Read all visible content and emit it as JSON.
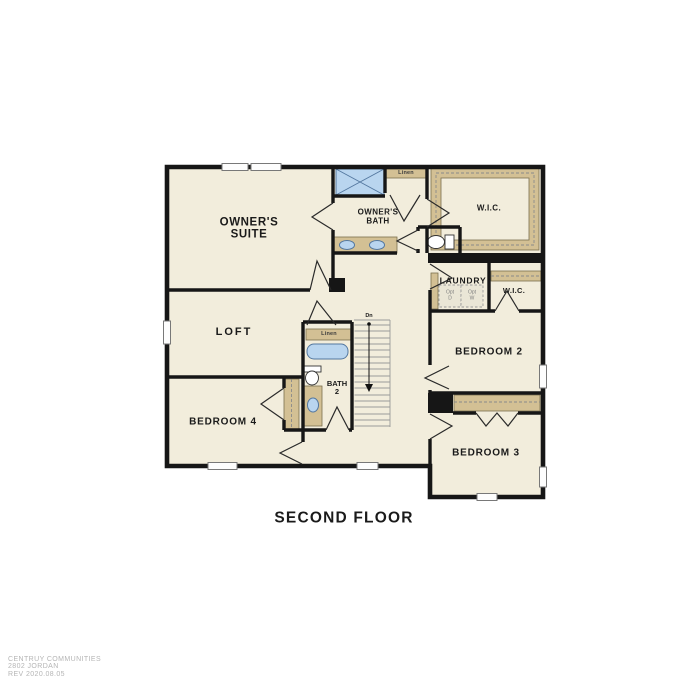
{
  "title": "SECOND FLOOR",
  "footer": {
    "line1": "CENTRUY COMMUNITIES",
    "line2": "2802 JORDAN",
    "line3": "REV 2020.08.05"
  },
  "colors": {
    "room_fill": "#f2eddc",
    "wall": "#161616",
    "cabinet_tan": "#d3c094",
    "fixture_blue": "#b9d5ef",
    "fixture_blue_border": "#53779f",
    "stair_gray": "#9a9a9a",
    "footer_gray": "#b5b5b5"
  },
  "plan": {
    "rooms": {
      "owners_suite": {
        "line1": "OWNER'S",
        "line2": "SUITE"
      },
      "owners_bath": {
        "line1": "OWNER'S",
        "line2": "BATH"
      },
      "wic_owners": {
        "label": "W.I.C."
      },
      "laundry": {
        "label": "LAUNDRY"
      },
      "opt_dryer": {
        "line1": "Opt",
        "line2": "D"
      },
      "opt_washer": {
        "line1": "Opt",
        "line2": "W"
      },
      "wic_bedroom2": {
        "label": "W.I.C."
      },
      "bedroom2": {
        "label": "BEDROOM 2"
      },
      "bedroom3": {
        "label": "BEDROOM 3"
      },
      "bedroom4": {
        "label": "BEDROOM 4"
      },
      "loft": {
        "label": "LOFT"
      },
      "bath2": {
        "line1": "BATH",
        "line2": "2"
      },
      "linen_owners_bath": {
        "label": "Linen"
      },
      "linen_hall": {
        "label": "Linen"
      },
      "stairs": {
        "down_label": "Dn"
      }
    }
  }
}
